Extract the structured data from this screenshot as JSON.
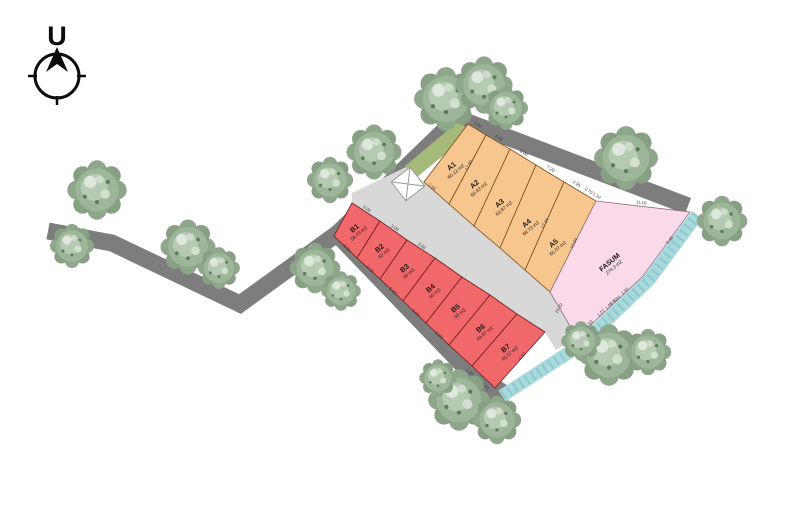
{
  "compass": {
    "label": "U"
  },
  "colors": {
    "road": "#7d7d7d",
    "divider_strip": "#d8d8d8",
    "grass": "#a5b97b",
    "river": "#a8d9dd",
    "river_texture": "#74b7bf",
    "zone_a": "#f7c68e",
    "zone_b": "#f1686b",
    "zone_fasum": "#fad9e9"
  },
  "site": {
    "plots": [
      {
        "id": "A1",
        "area": "60.12 m2",
        "zone": "a",
        "points": "468,124 486,135 449,204 424,182",
        "label": [
          453,
          168
        ],
        "rot": -40
      },
      {
        "id": "A2",
        "area": "60.93 m2",
        "zone": "a",
        "points": "486,135 510,149 474,226 449,204",
        "label": [
          476,
          186
        ],
        "rot": -40
      },
      {
        "id": "A3",
        "area": "63.87 m2",
        "zone": "a",
        "points": "510,149 536,165 500,248 474,226",
        "label": [
          501,
          205
        ],
        "rot": -40
      },
      {
        "id": "A4",
        "area": "68.73 m2",
        "zone": "a",
        "points": "536,165 564,182 525,270 500,248",
        "label": [
          528,
          225
        ],
        "rot": -40
      },
      {
        "id": "A5",
        "area": "65.07 m2",
        "zone": "a",
        "points": "564,182 596,201 550,292 525,270",
        "label": [
          555,
          245
        ],
        "rot": -40
      },
      {
        "id": "FASUM",
        "area": "274.3 m2",
        "zone": "fasum",
        "points": "596,201 690,212 643,276 577,338 550,292",
        "label": [
          611,
          264
        ],
        "rot": -40
      },
      {
        "id": "B1",
        "area": "56.73 m2",
        "zone": "b",
        "points": "352,203 380,221 357,258 334,236",
        "label": [
          356,
          230
        ],
        "rot": -40
      },
      {
        "id": "B2",
        "area": "50 m2",
        "zone": "b",
        "points": "380,221 407,240 380,279 357,258",
        "label": [
          381,
          250
        ],
        "rot": -40
      },
      {
        "id": "B3",
        "area": "50 m2",
        "zone": "b",
        "points": "407,240 435,258 403,301 380,279",
        "label": [
          406,
          270
        ],
        "rot": -40
      },
      {
        "id": "B4",
        "area": "50 m2",
        "zone": "b",
        "points": "435,258 462,277 426,323 403,301",
        "label": [
          432,
          290
        ],
        "rot": -40
      },
      {
        "id": "B5",
        "area": "50 m2",
        "zone": "b",
        "points": "462,277 490,295 449,345 426,323",
        "label": [
          457,
          310
        ],
        "rot": -40
      },
      {
        "id": "B6",
        "area": "49.87 m2",
        "zone": "b",
        "points": "490,295 517,314 472,366 449,345",
        "label": [
          482,
          330
        ],
        "rot": -40
      },
      {
        "id": "B7",
        "area": "45.57 m2",
        "zone": "b",
        "points": "517,314 545,332 495,388 472,366",
        "label": [
          507,
          350
        ],
        "rot": -40
      }
    ],
    "dimensions": [
      {
        "t": "3.00",
        "x": 477,
        "y": 126,
        "r": 31
      },
      {
        "t": "4.44",
        "x": 498,
        "y": 139,
        "r": 31
      },
      {
        "t": "5.00",
        "x": 523,
        "y": 154,
        "r": 31
      },
      {
        "t": "7.20",
        "x": 550,
        "y": 170,
        "r": 31
      },
      {
        "t": "2.95",
        "x": 576,
        "y": 185,
        "r": 31
      },
      {
        "t": "2.70",
        "x": 588,
        "y": 192,
        "r": 31
      },
      {
        "t": "1.10",
        "x": 596,
        "y": 197,
        "r": 31
      },
      {
        "t": "11.18",
        "x": 641,
        "y": 204,
        "r": 7
      },
      {
        "t": "17.80",
        "x": 470,
        "y": 166,
        "r": -60
      },
      {
        "t": "17.34",
        "x": 546,
        "y": 224,
        "r": -60
      },
      {
        "t": "14.04",
        "x": 575,
        "y": 244,
        "r": -62
      },
      {
        "t": "2.93",
        "x": 431,
        "y": 188,
        "r": 40
      },
      {
        "t": "5.40",
        "x": 671,
        "y": 241,
        "r": -53
      },
      {
        "t": "7.40",
        "x": 614,
        "y": 303,
        "r": -43
      },
      {
        "t": "4.33",
        "x": 590,
        "y": 325,
        "r": -43
      },
      {
        "t": "1.27",
        "x": 602,
        "y": 314,
        "r": -43
      },
      {
        "t": "1.09",
        "x": 610,
        "y": 307,
        "r": -43
      },
      {
        "t": "1.41",
        "x": 618,
        "y": 300,
        "r": -43
      },
      {
        "t": "1.41",
        "x": 626,
        "y": 292,
        "r": -43
      },
      {
        "t": "10.20",
        "x": 560,
        "y": 309,
        "r": -60
      },
      {
        "t": "5.00",
        "x": 346,
        "y": 249,
        "r": 43
      },
      {
        "t": "5.00",
        "x": 369,
        "y": 270,
        "r": 43
      },
      {
        "t": "5.00",
        "x": 392,
        "y": 292,
        "r": 43
      },
      {
        "t": "5.00",
        "x": 415,
        "y": 314,
        "r": 43
      },
      {
        "t": "5.00",
        "x": 438,
        "y": 336,
        "r": 43
      },
      {
        "t": "1.50",
        "x": 469,
        "y": 373,
        "r": 43
      },
      {
        "t": "1.50",
        "x": 477,
        "y": 380,
        "r": 43
      },
      {
        "t": "1.41",
        "x": 485,
        "y": 387,
        "r": 43
      },
      {
        "t": "4.93",
        "x": 523,
        "y": 357,
        "r": -48
      },
      {
        "t": "3.00",
        "x": 366,
        "y": 210,
        "r": 33
      },
      {
        "t": "3.00",
        "x": 394,
        "y": 229,
        "r": 33
      },
      {
        "t": "3.00",
        "x": 421,
        "y": 247,
        "r": 33
      }
    ],
    "trees": [
      [
        97,
        190,
        1.35
      ],
      [
        72,
        246,
        1.0
      ],
      [
        188,
        247,
        1.25
      ],
      [
        219,
        268,
        0.95
      ],
      [
        315,
        268,
        1.15
      ],
      [
        341,
        291,
        0.9
      ],
      [
        330,
        180,
        1.05
      ],
      [
        374,
        152,
        1.25
      ],
      [
        446,
        99,
        1.45
      ],
      [
        484,
        85,
        1.3
      ],
      [
        506,
        108,
        1.0
      ],
      [
        626,
        158,
        1.45
      ],
      [
        722,
        221,
        1.15
      ],
      [
        609,
        355,
        1.4
      ],
      [
        648,
        352,
        1.05
      ],
      [
        581,
        341,
        0.9
      ],
      [
        459,
        400,
        1.4
      ],
      [
        497,
        420,
        1.1
      ],
      [
        438,
        378,
        0.85
      ]
    ]
  }
}
